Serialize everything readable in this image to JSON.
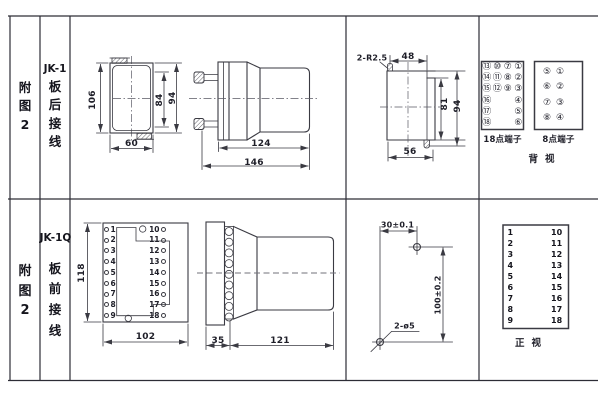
{
  "row1": {
    "figure": [
      "附",
      "图",
      "2"
    ],
    "model": "JK-1",
    "wiring": [
      "板",
      "后",
      "接",
      "线"
    ],
    "rear_view": {
      "height": "106",
      "width": "60",
      "screw_span": "84",
      "overall_height": "94"
    },
    "side_view": {
      "case_depth": "124",
      "total_depth": "146"
    },
    "cutout": {
      "corner_radius": "2-R2.5",
      "top_width": "48",
      "inner_height": "81",
      "height": "94",
      "width": "56"
    },
    "terminal18": {
      "label": "18点端子",
      "cells": [
        "⑬",
        "⑩",
        "⑦",
        "①",
        "⑭",
        "⑪",
        "⑧",
        "②",
        "⑮",
        "⑫",
        "⑨",
        "③",
        "⑯",
        "",
        "",
        "④",
        "⑰",
        "",
        "",
        "⑤",
        "⑱",
        "",
        "",
        "⑥"
      ]
    },
    "terminal8": {
      "label": "8点端子",
      "cells": [
        "⑤",
        "①",
        "⑥",
        "②",
        "⑦",
        "③",
        "⑧",
        "④"
      ]
    },
    "view_label": "背视"
  },
  "row2": {
    "figure": [
      "附",
      "图",
      "2"
    ],
    "model": "JK-1Q",
    "wiring": [
      "板",
      "前",
      "接",
      "线"
    ],
    "board": {
      "height": "118",
      "width": "102",
      "left_terminals": [
        "1",
        "2",
        "3",
        "4",
        "5",
        "6",
        "7",
        "8",
        "9"
      ],
      "right_terminals": [
        "10",
        "11",
        "12",
        "13",
        "14",
        "15",
        "16",
        "17",
        "18"
      ]
    },
    "side_view": {
      "terminal_depth": "35",
      "case_depth": "121"
    },
    "drill": {
      "hole_spacing_h": "30±0.1",
      "hole_spacing_v": "100±0.2",
      "holes": "2-ø5"
    },
    "front_list": {
      "left": [
        "1",
        "2",
        "3",
        "4",
        "5",
        "6",
        "7",
        "8",
        "9"
      ],
      "right": [
        "10",
        "11",
        "12",
        "13",
        "14",
        "15",
        "16",
        "17",
        "18"
      ],
      "view_label": "正视"
    }
  }
}
